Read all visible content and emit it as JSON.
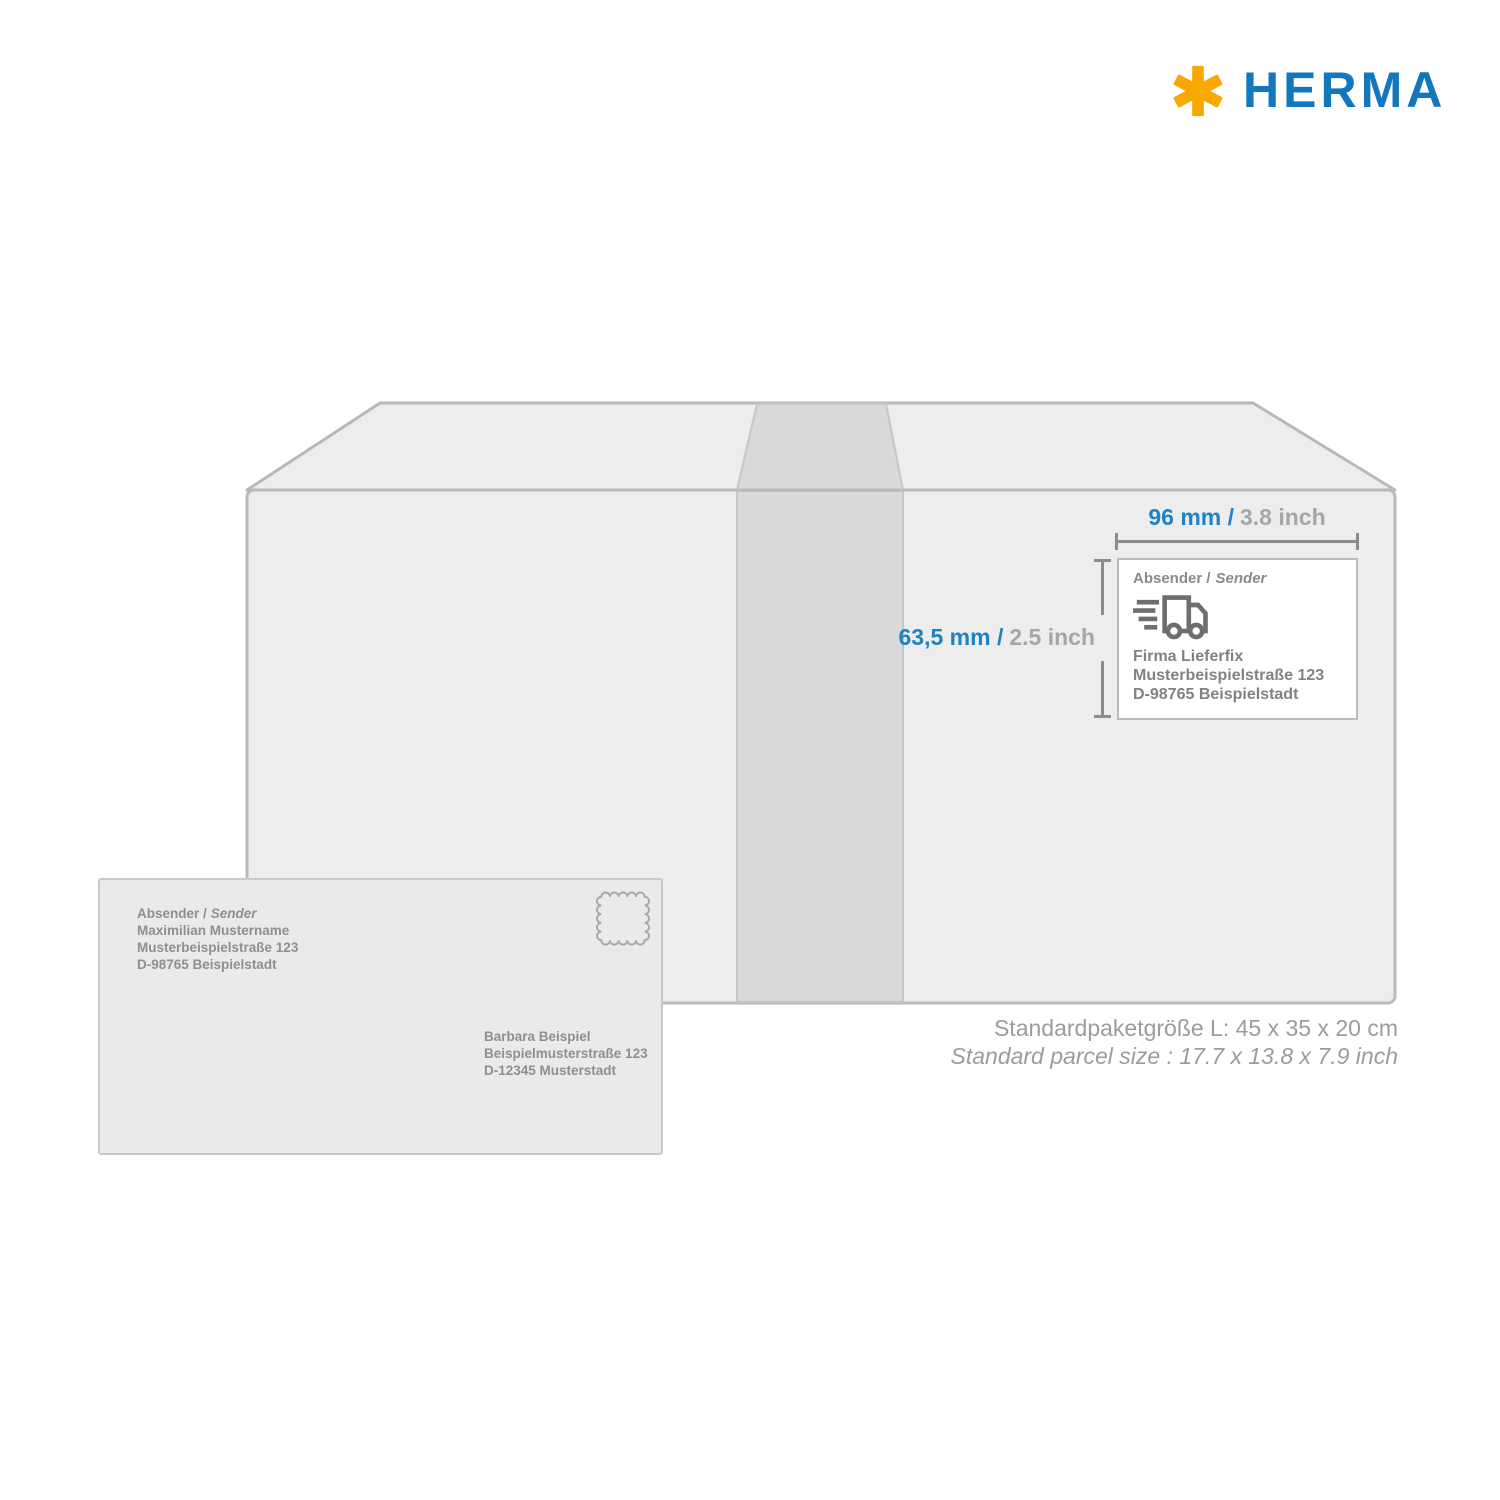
{
  "logo": {
    "brand": "HERMA"
  },
  "icons": {
    "logo_mark": "herma-asterisk-icon",
    "label_icon": "delivery-truck-icon",
    "envelope_icon": "postage-stamp-icon"
  },
  "colors": {
    "brand_blue": "#1377BD",
    "brand_orange": "#F9A800",
    "dimension_blue": "#1E82C4",
    "dimension_gray": "#A6A6A6",
    "box_fill": "#EDEDED",
    "box_stroke": "#B9B9B9",
    "tape_fill": "#D9D9D9",
    "envelope_fill": "#EAEAEA"
  },
  "parcel": {
    "width_dimension": {
      "metric": "96 mm /",
      "imperial": "3.8 inch"
    },
    "height_dimension": {
      "metric": "63,5 mm /",
      "imperial": "2.5 inch"
    },
    "label": {
      "header_de": "Absender /",
      "header_en": "Sender",
      "address_lines": [
        "Firma Lieferfix",
        "Musterbeispielstraße 123",
        "D-98765 Beispielstadt"
      ]
    },
    "size_note_de": "Standardpaketgröße L: 45 x 35 x 20 cm",
    "size_note_en": "Standard parcel size : 17.7 x 13.8 x 7.9 inch"
  },
  "envelope": {
    "sender_header_de": "Absender /",
    "sender_header_en": "Sender",
    "sender_lines": [
      "Maximilian Mustername",
      "Musterbeispielstraße 123",
      "D-98765 Beispielstadt"
    ],
    "recipient_lines": [
      "Barbara Beispiel",
      "Beispielmusterstraße 123",
      "D-12345 Musterstadt"
    ]
  }
}
